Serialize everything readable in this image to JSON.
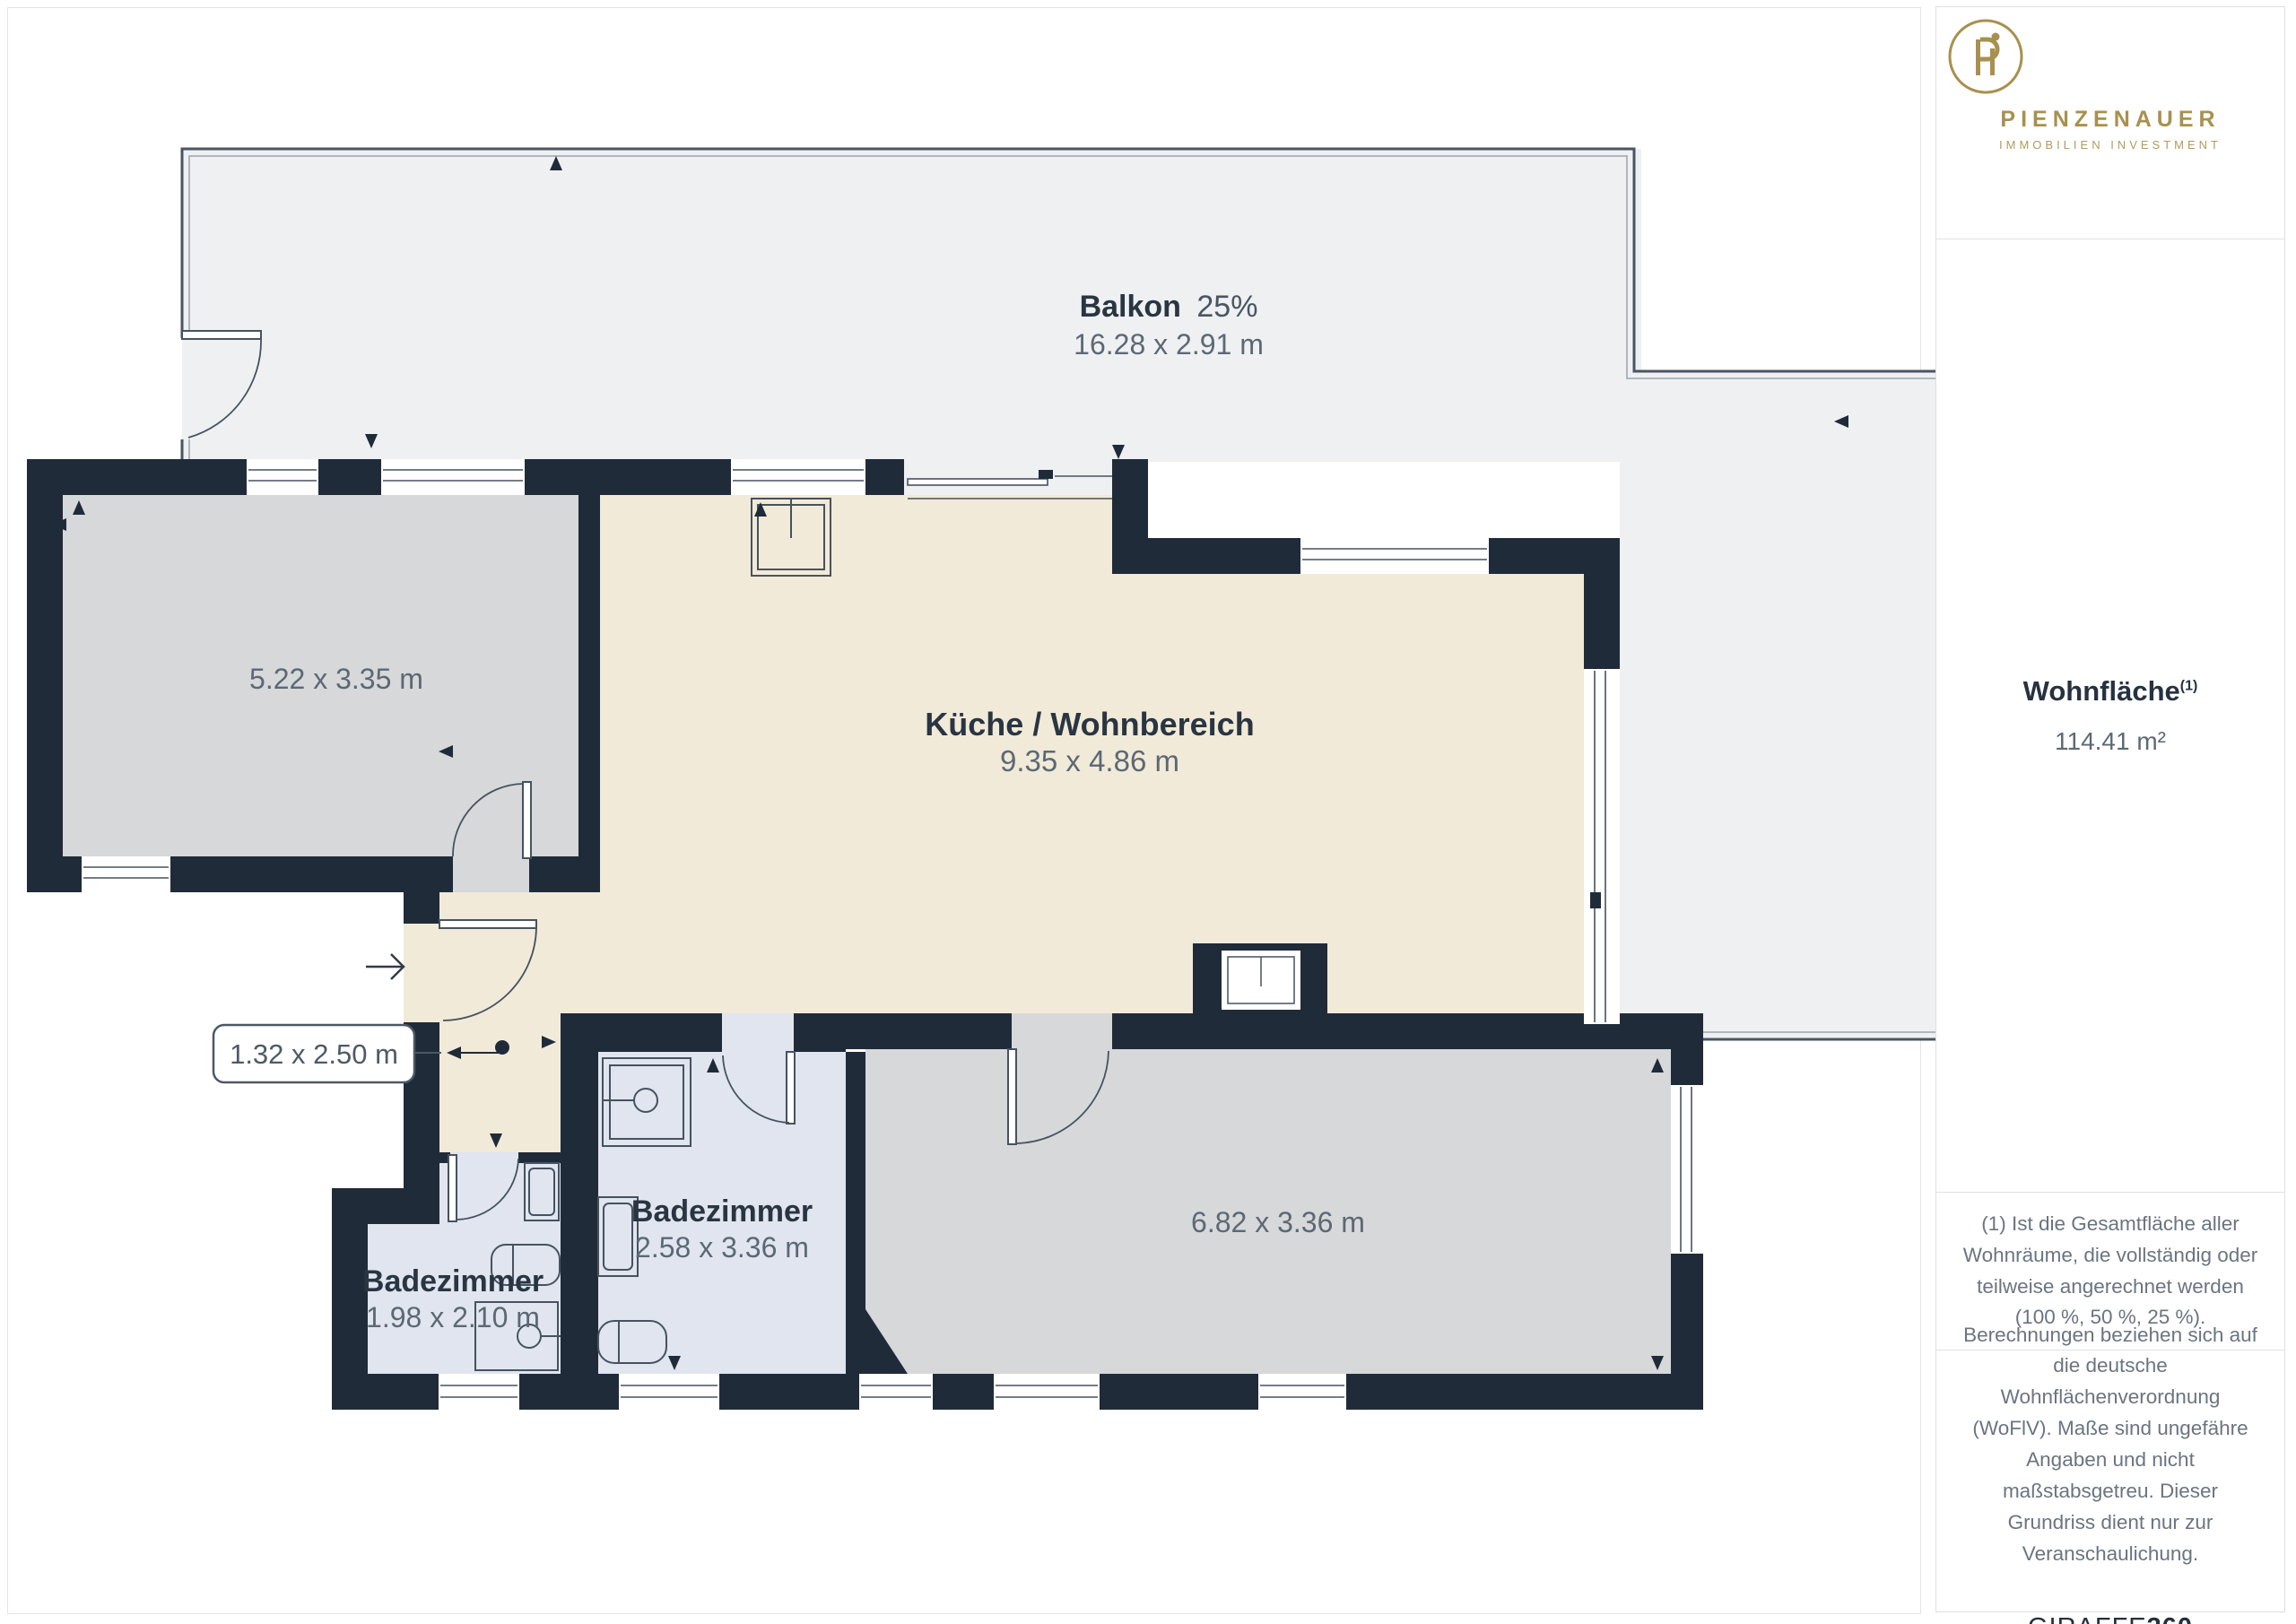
{
  "floorplan": {
    "balcony": {
      "name": "Balkon",
      "percent": "25%",
      "dims": "16.28 x 2.91 m"
    },
    "room_left": {
      "dims": "5.22 x 3.35 m"
    },
    "kitchen": {
      "name": "Küche / Wohnbereich",
      "dims": "9.35 x 4.86 m"
    },
    "hall_callout": {
      "dims": "1.32 x 2.50 m"
    },
    "bathroom_main": {
      "name": "Badezimmer",
      "dims": "2.58 x 3.36 m"
    },
    "bathroom_small": {
      "name": "Badezimmer",
      "dims": "1.98 x 2.10 m"
    },
    "bedroom": {
      "dims": "6.82 x 3.36 m"
    }
  },
  "sidebar": {
    "brand": {
      "name": "PIENZENAUER",
      "tagline": "IMMOBILIEN INVESTMENT"
    },
    "area": {
      "label": "Wohnfläche",
      "footnote_ref": "(1)",
      "value": "114.41 m²"
    },
    "footnote": "(1) Ist die Gesamtfläche aller Wohnräume, die vollständig oder teilweise angerechnet werden (100 %, 50 %, 25 %).",
    "disclaimer": "Berechnungen beziehen sich auf die deutsche Wohnflächenverordnung (WoFlV). Maße sind ungefähre Angaben und nicht maßstabsgetreu. Dieser Grundriss dient nur zur Veranschaulichung.",
    "watermark": {
      "brand": "GIRAFFE",
      "suffix": "360"
    }
  },
  "colors": {
    "wall": "#202b3a",
    "balcony_fill": "#eef0f2",
    "room_fill": "#d6d8da",
    "kitchen_fill": "#f1ead8",
    "bath_fill": "#e0e5ef",
    "line": "#47525f",
    "label_dark": "#2a3542",
    "label_gray": "#5d6874",
    "gold": "#a8904e"
  }
}
